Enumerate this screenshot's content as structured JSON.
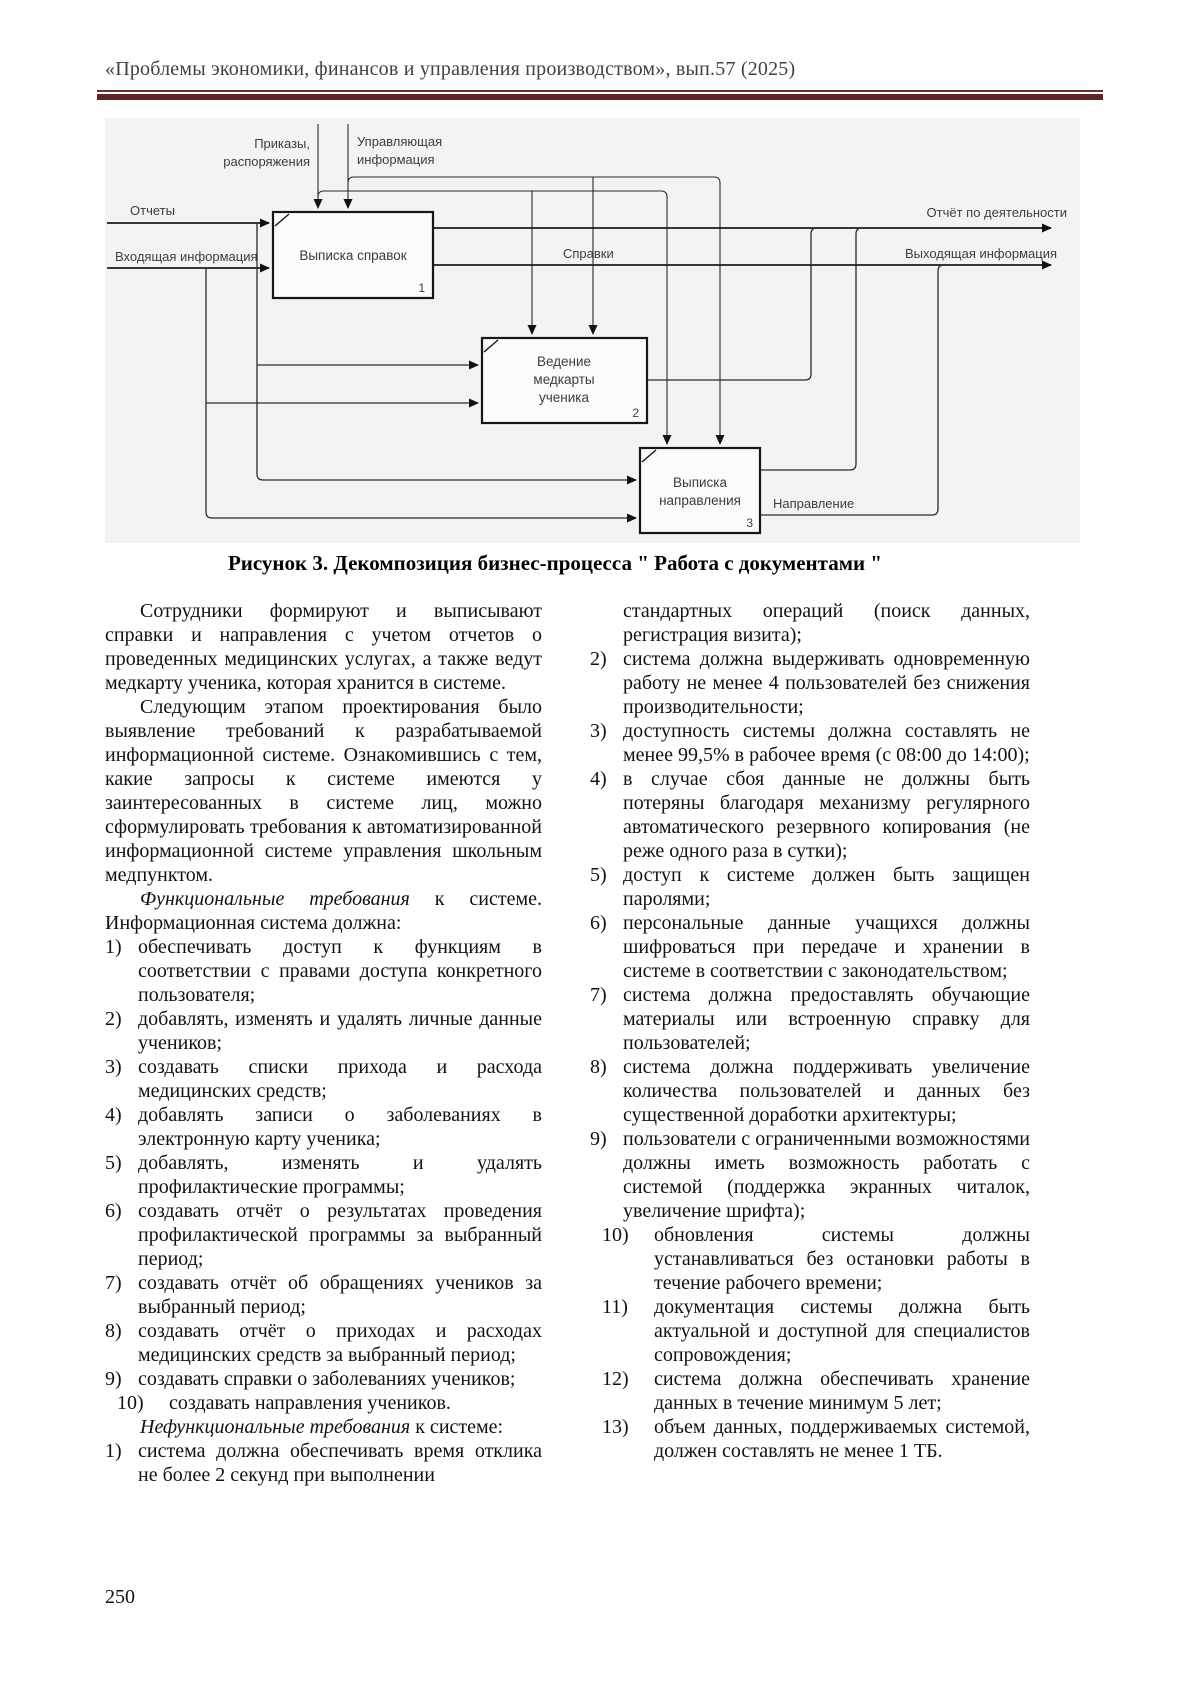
{
  "page": {
    "header": "«Проблемы экономики, финансов и управления производством», вып.57 (2025)",
    "page_number": "250",
    "colors": {
      "rule_top": "#6f2e33",
      "rule_band": "#5e2429",
      "figure_background": "#f3f3f3"
    }
  },
  "figure": {
    "caption": "Рисунок 3. Декомпозиция бизнес-процесса \" Работа с документами \"",
    "boxes": [
      {
        "number": "1",
        "lines": [
          "Выписка справок"
        ]
      },
      {
        "number": "2",
        "lines": [
          "Ведение",
          "медкарты",
          "ученика"
        ]
      },
      {
        "number": "3",
        "lines": [
          "Выписка",
          "направления"
        ]
      }
    ],
    "arrow_labels": {
      "prikazy_1": "Приказы,",
      "prikazy_2": "распоряжения",
      "upravl_1": "Управляющая",
      "upravl_2": "информация",
      "otchety": "Отчеты",
      "vhod": "Входящая информация",
      "spravki": "Справки",
      "otchet_po": "Отчёт по деятельности",
      "vyhod": "Выходящая информация",
      "napravlenie": "Направление"
    }
  },
  "content": {
    "left": {
      "p1": "Сотрудники формируют и выписывают справки и направления с учетом отчетов о проведенных медицинских услугах, а также ведут медкарту ученика, которая хранится в системе.",
      "p2": "Следующим этапом проектирования было выявление требований к разрабатываемой информационной системе. Ознакомившись с тем, какие запросы к системе имеются у заинтересованных в системе лиц, можно сформулировать требования к автоматизированной информационной системе управления школьным медпунктом.",
      "func_lead_italic": "Функциональные требования",
      "func_lead_rest": " к системе. Информационная система должна:",
      "func_items": [
        {
          "num": "1)",
          "text": "обеспечивать доступ к функциям в соответствии с правами доступа конкретного пользователя;"
        },
        {
          "num": "2)",
          "text": "добавлять, изменять и удалять личные данные учеников;"
        },
        {
          "num": "3)",
          "text": "создавать списки прихода и расхода медицинских средств;"
        },
        {
          "num": "4)",
          "text": "добавлять записи о заболеваниях в электронную карту ученика;"
        },
        {
          "num": "5)",
          "text": "добавлять, изменять и удалять профилактические программы;"
        },
        {
          "num": "6)",
          "text": "создавать отчёт о результатах проведения профилактической программы за выбранный период;"
        },
        {
          "num": "7)",
          "text": "создавать отчёт об обращениях учеников за выбранный период;"
        },
        {
          "num": "8)",
          "text": "создавать отчёт о приходах и расходах медицинских средств за выбранный период;"
        },
        {
          "num": "9)",
          "text": "создавать справки о заболеваниях учеников;"
        },
        {
          "num": "10)",
          "text": "создавать направления учеников."
        }
      ],
      "nonfunc_lead_italic": "Нефункциональные требования",
      "nonfunc_lead_rest": " к системе:",
      "nonfunc_item1": {
        "num": "1)",
        "text": "система должна обеспечивать время отклика не более 2 секунд при выполнении"
      }
    },
    "right": {
      "item1_cont": "стандартных операций (поиск данных, регистрация визита);",
      "items": [
        {
          "num": "2)",
          "text": "система должна выдерживать одновременную работу не менее 4 пользователей без снижения производительности;"
        },
        {
          "num": "3)",
          "text": "доступность системы должна составлять не менее 99,5% в рабочее время (с 08:00 до 14:00);"
        },
        {
          "num": "4)",
          "text": "в случае сбоя данные не должны быть потеряны благодаря механизму регулярного автоматического резервного копирования (не реже одного раза в сутки);"
        },
        {
          "num": "5)",
          "text": "доступ к системе должен быть защищен паролями;"
        },
        {
          "num": "6)",
          "text": "персональные данные учащихся должны шифроваться при передаче и хранении в системе в соответствии с законодательством;"
        },
        {
          "num": "7)",
          "text": "система должна предоставлять обучающие материалы или встроенную справку для пользователей;"
        },
        {
          "num": "8)",
          "text": "система должна поддерживать увеличение количества пользователей и данных без существенной доработки архитектуры;"
        },
        {
          "num": "9)",
          "text": "пользователи с ограниченными возможностями должны иметь возможность работать с системой (поддержка экранных читалок, увеличение шрифта);"
        },
        {
          "num": "10)",
          "text": "обновления системы должны устанавливаться без остановки работы в течение рабочего времени;"
        },
        {
          "num": "11)",
          "text": "документация системы должна быть актуальной и доступной для специалистов сопровождения;"
        },
        {
          "num": "12)",
          "text": "система должна обеспечивать хранение данных в течение минимум 5 лет;"
        },
        {
          "num": "13)",
          "text": "объем данных, поддерживаемых системой, должен составлять не менее 1 ТБ."
        }
      ]
    }
  }
}
